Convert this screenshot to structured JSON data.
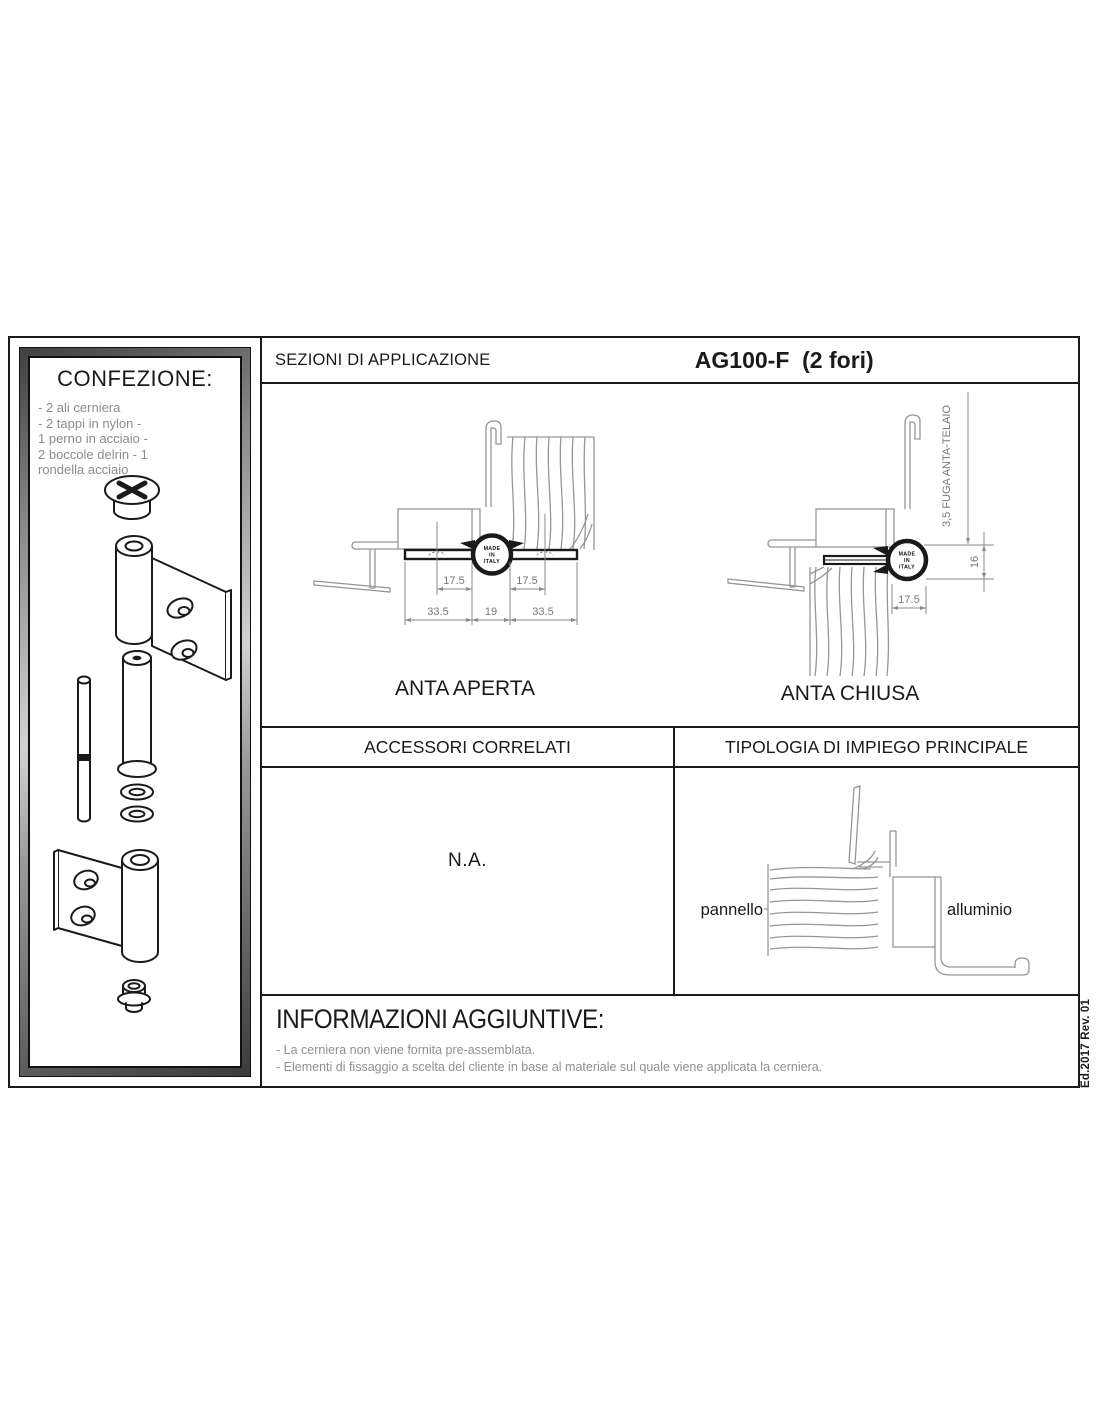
{
  "colors": {
    "line_gray": "#969696",
    "dim_gray": "#8a8a8a",
    "text_gray": "#8c8c8c",
    "black": "#1a1a1a"
  },
  "confezione": {
    "title": "CONFEZIONE:",
    "lines": [
      "- 2 ali cerniera",
      "- 2 tappi in nylon -",
      "1 perno in acciaio -",
      "2 boccole delrin - 1",
      "rondella acciaio"
    ]
  },
  "header": {
    "section_title": "SEZIONI DI APPLICAZIONE",
    "product_code": "AG100-F  (2 fori)"
  },
  "hinge_mark": [
    "MADE",
    "IN",
    "ITALY"
  ],
  "sections": {
    "anta_aperta": {
      "caption": "ANTA APERTA",
      "dim_17_5_left": "17.5",
      "dim_17_5_right": "17.5",
      "dim_33_5_left": "33.5",
      "dim_19": "19",
      "dim_33_5_right": "33.5"
    },
    "anta_chiusa": {
      "caption": "ANTA CHIUSA",
      "fuga_label": "3,5 FUGA ANTA-TELAIO",
      "dim_16": "16",
      "dim_17_5": "17.5"
    },
    "accessori": {
      "title": "ACCESSORI CORRELATI",
      "value": "N.A."
    },
    "tipologia": {
      "title": "TIPOLOGIA DI IMPIEGO PRINCIPALE",
      "label_panel": "pannello",
      "label_aluminium": "alluminio"
    },
    "informazioni": {
      "title": "INFORMAZIONI AGGIUNTIVE:",
      "notes": [
        "- La cerniera non viene fornita pre-assemblata.",
        "- Elementi di fissaggio a scelta del cliente in base al materiale sul quale viene applicata la cerniera."
      ]
    }
  },
  "edition": "Ed.2017 Rev. 01"
}
